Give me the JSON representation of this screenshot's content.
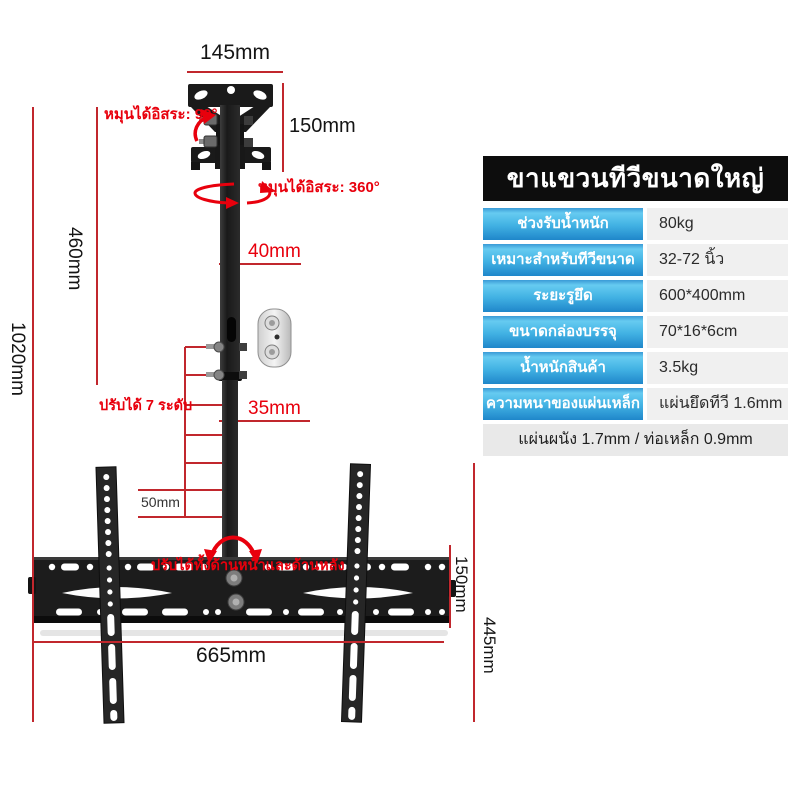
{
  "spec_table": {
    "title": "ขาแขวนทีวีขนาดใหญ่",
    "rows": [
      {
        "label": "ช่วงรับน้ำหนัก",
        "value": "80kg"
      },
      {
        "label": "เหมาะสำหรับทีวีขนาด",
        "value": "32-72 นิ้ว"
      },
      {
        "label": "ระยะรูยึด",
        "value": "600*400mm"
      },
      {
        "label": "ขนาดกล่องบรรจุ",
        "value": "70*16*6cm"
      },
      {
        "label": "น้ำหนักสินค้า",
        "value": "3.5kg"
      },
      {
        "label": "ความหนาของแผ่นเหล็ก",
        "value": "แผ่นยึดทีวี 1.6mm"
      }
    ],
    "footer": "แผ่นผนัง 1.7mm / ท่อเหล็ก 0.9mm"
  },
  "annotations": {
    "top_plate_width": "145mm",
    "top_plate_height": "150mm",
    "rotate_free_90": "หมุนได้อิสระ: 90°",
    "rotate_free_360": "หมุนได้อิสระ: 360°",
    "upper_tube_width": "40mm",
    "lower_tube_width": "35mm",
    "adjust_levels": "ปรับได้ 7 ระดับ",
    "level_step": "50mm",
    "upper_section_height": "460mm",
    "total_height": "1020mm",
    "bracket_width": "665mm",
    "bracket_height": "150mm",
    "lower_section_height": "445mm",
    "tilt_note": "ปรับได้ทั้งด้านหน้าและด้านหลัง"
  },
  "colors": {
    "dimension_line_red": "#c1272d",
    "annotation_red": "#e8000d",
    "header_bg": "#0d0d0d",
    "label_blue_top": "#66cbf1",
    "label_blue_bottom": "#1f86ca",
    "value_bg": "#f0f0f0",
    "footer_bg": "#e9e9e9",
    "hardware_black": "#1c1c1c"
  }
}
